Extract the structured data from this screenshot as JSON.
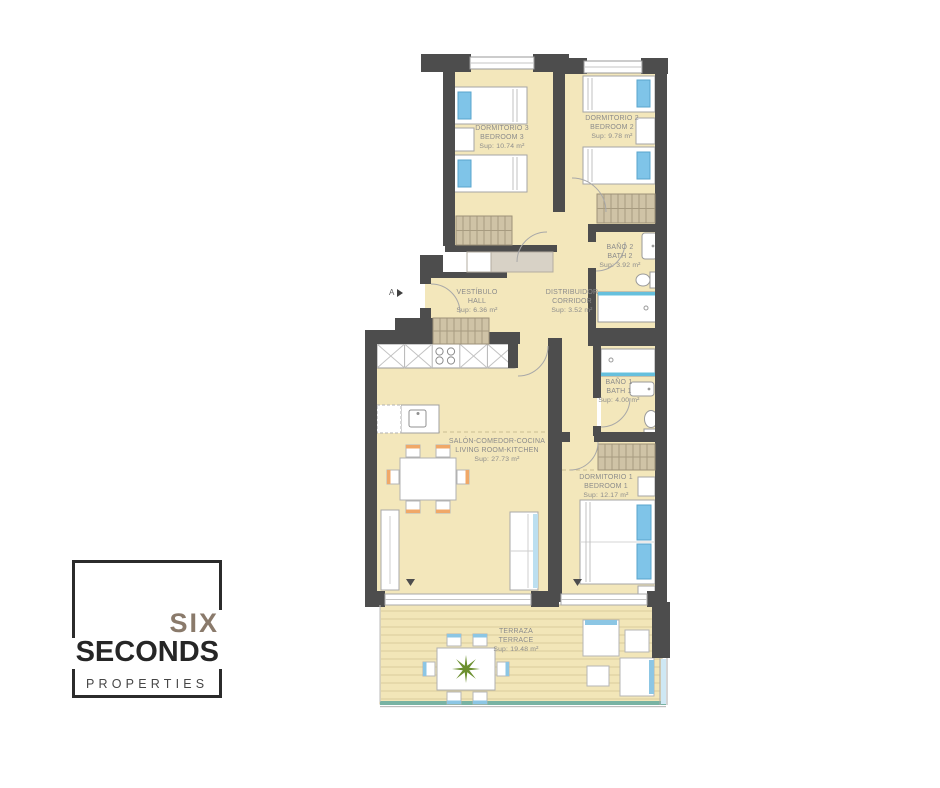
{
  "plan": {
    "section_marker": "A",
    "rooms": {
      "bedroom3": {
        "name_es": "DORMITORIO 3",
        "name_en": "BEDROOM 3",
        "area": "Sup: 10.74 m²"
      },
      "bedroom2": {
        "name_es": "DORMITORIO 2",
        "name_en": "BEDROOM 2",
        "area": "Sup: 9.78 m²"
      },
      "bath2": {
        "name_es": "BAÑO 2",
        "name_en": "BATH 2",
        "area": "Sup: 3.92 m²"
      },
      "hall": {
        "name_es": "VESTÍBULO",
        "name_en": "HALL",
        "area": "Sup: 6.36 m²"
      },
      "corridor": {
        "name_es": "DISTRIBUIDOR",
        "name_en": "CORRIDOR",
        "area": "Sup: 3.52 m²"
      },
      "bath1": {
        "name_es": "BAÑO 1",
        "name_en": "BATH 1",
        "area": "Sup: 4.00 m²"
      },
      "living": {
        "name_es": "SALÓN-COMEDOR-COCINA",
        "name_en": "LIVING ROOM-KITCHEN",
        "area": "Sup: 27.73 m²"
      },
      "bedroom1": {
        "name_es": "DORMITORIO 1",
        "name_en": "BEDROOM 1",
        "area": "Sup: 12.17 m²"
      },
      "terrace": {
        "name_es": "TERRAZA",
        "name_en": "TERRACE",
        "area": "Sup: 19.48 m²"
      }
    },
    "colors": {
      "wall": "#4d4d4d",
      "floor": "#f3e7bb",
      "deck_line": "#d9cc9b",
      "closet": "#cfc3a6",
      "accent_blue": "#7fc4e8",
      "accent_teal": "#79b3a3",
      "chair_orange": "#f0a868",
      "plant_green": "#6b8f2e",
      "label_text": "#8b8b8b"
    }
  },
  "logo": {
    "line1": "SIX",
    "line2": "SECONDS",
    "line3": "PROPERTIES"
  }
}
